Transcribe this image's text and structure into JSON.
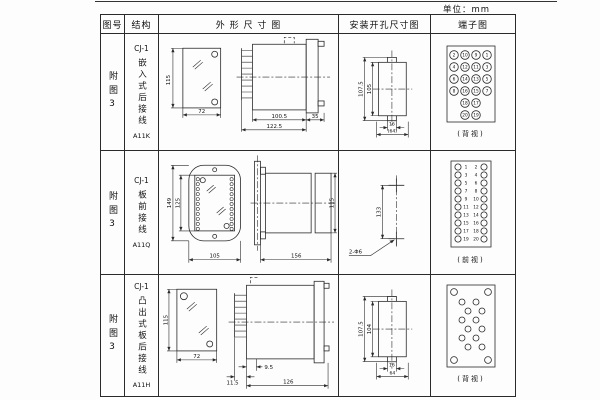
{
  "page": {
    "unit_label": "单位：mm"
  },
  "table": {
    "headers": {
      "col1": "图号",
      "col2": "结构",
      "col3": "外 形 尺 寸 图",
      "col4": "安装开孔尺寸图",
      "col5": "端子图"
    },
    "rows": [
      {
        "figure_no": "附图3",
        "structure": {
          "series": "CJ-1",
          "name": "嵌入式后接线",
          "model": "A11K"
        },
        "outline": {
          "front_h": "115",
          "front_w": "72",
          "body_depth": "100.5",
          "total_depth": "122.5",
          "flange": "35"
        },
        "mounting": {
          "v_outer": "107.5",
          "v_inner": "105",
          "h_inner": "16",
          "h_outer": "(64)"
        },
        "terminal": {
          "view_label": "(背视)",
          "cols": {
            "outer_left": [
              "2",
              "4",
              "6",
              "8"
            ],
            "mid_left": [
              "10",
              "12",
              "14",
              "16",
              "18",
              "20"
            ],
            "mid_right": [
              "9",
              "11",
              "13",
              "15",
              "17",
              "19"
            ],
            "outer_right": [
              "1",
              "3",
              "5",
              "7"
            ]
          }
        }
      },
      {
        "figure_no": "附图3",
        "structure": {
          "series": "CJ-1",
          "name": "板前接线",
          "model": "A11Q"
        },
        "outline": {
          "front_h_outer": "149",
          "front_h_inner": "125",
          "front_w": "105",
          "side_len": "156",
          "side_h": "115"
        },
        "mounting": {
          "spacing": "133",
          "holes": "2-Φ6"
        },
        "terminal": {
          "view_label": "(前视)",
          "left": [
            "1",
            "3",
            "5",
            "7",
            "9",
            "11",
            "13",
            "15",
            "17",
            "19"
          ],
          "right": [
            "2",
            "4",
            "6",
            "8",
            "10",
            "12",
            "14",
            "16",
            "18",
            "20"
          ]
        }
      },
      {
        "figure_no": "附图3",
        "structure": {
          "series": "CJ-1",
          "name": "凸出式板后接线",
          "model": "A11H"
        },
        "outline": {
          "front_h": "115",
          "front_w": "72",
          "pin_len": "11.5",
          "pin_offset": "9.5",
          "body_len": "126"
        },
        "mounting": {
          "v_outer": "107.5",
          "v_inner": "104",
          "h_inner": "16",
          "h_outer": "64"
        },
        "terminal": {
          "view_label": "(背视)"
        }
      }
    ]
  }
}
